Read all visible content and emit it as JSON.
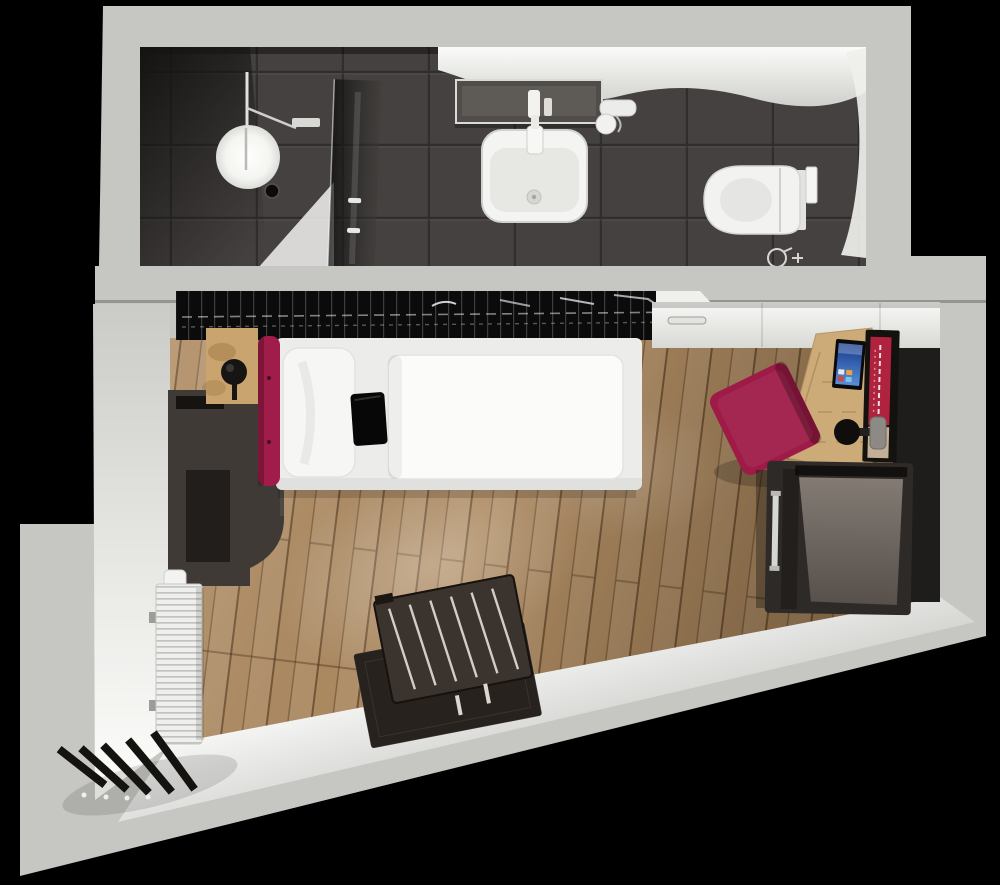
{
  "scene": {
    "title": "studio-apartment-3d-floor-plan",
    "rooms": [
      {
        "name": "bathroom",
        "objects": [
          "shower",
          "shower-ceiling-light",
          "shower-glass-partition",
          "shower-mixer",
          "shower-tray",
          "washbasin",
          "basin-faucet",
          "vanity-mirror-shelf",
          "hairdryer-holder",
          "wall-hung-toilet",
          "flush-plate",
          "toilet-paper-holder"
        ]
      },
      {
        "name": "main-room",
        "objects": [
          "open-wardrobe-rail",
          "interior-door",
          "single-bed",
          "headboard-cushion",
          "pillow",
          "duvet",
          "bed-tray-bag",
          "nightstand",
          "sphere-table-lamp",
          "storage-cabinet",
          "work-desk",
          "smart-tv",
          "wall-art-panel",
          "wall-reading-lamp",
          "desk-chair",
          "minibar-cabinet",
          "vertical-radiator",
          "luggage-rack",
          "door-mat",
          "entry-louver-slats",
          "wood-floor"
        ]
      }
    ]
  },
  "colors": {
    "background": "#000000",
    "outer_wall": "#c6c6c2",
    "divider_wall": "#c6c6c2",
    "bath_tile": "#454140",
    "niche_dark": "#1f1d1b",
    "rack_black": "#0b0b0b",
    "door_white": "#f0f0ed",
    "wood_floor": "#ad8a61",
    "wood_desk": "#ccab79",
    "wood_nightstand": "#c9a46f",
    "cabinet_dark": "#3f3a36",
    "minibar_dark": "#2e2a27",
    "mattress_white": "#ececea",
    "pillow_white": "#f6f6f4",
    "duvet_white": "#fbfbfa",
    "headboard_red": "#a01c4a",
    "chair_red": "#9e1a47",
    "art_red": "#b0233e",
    "art_beige": "#c3b096",
    "bag_black": "#070707",
    "toilet_white": "#f2f2f0",
    "sink_white": "#f4f4f2",
    "radiator_white": "#eff0ee",
    "slat_dark": "#15130f",
    "rug_dark": "#27221e",
    "rack_stand": "#3b332e",
    "screen_blue_top": "#153a8c",
    "screen_blue_bottom": "#5a8fd6"
  }
}
